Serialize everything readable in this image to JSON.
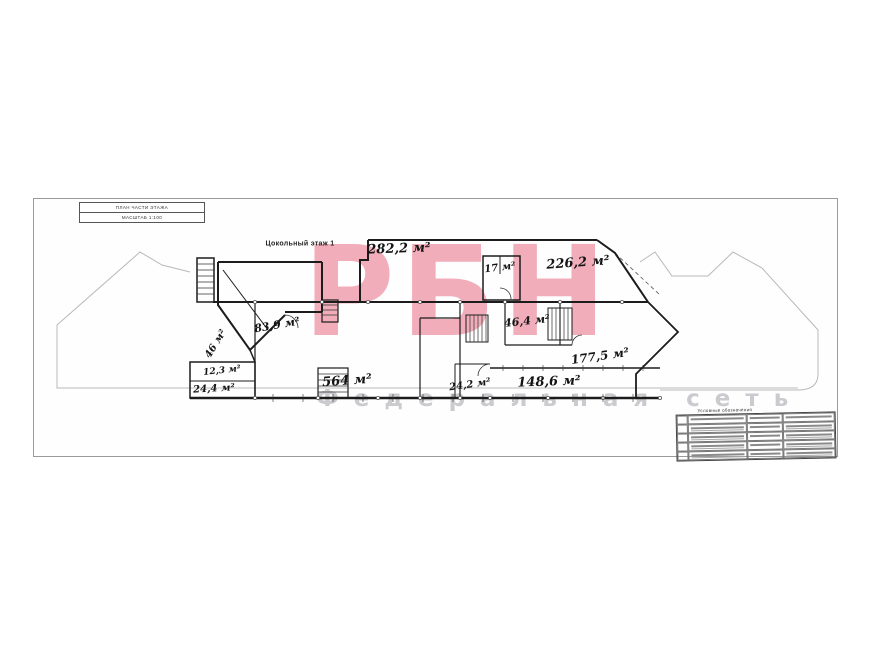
{
  "sheet": {
    "title_block": {
      "line1": "ПЛАН ЧАСТИ ЭТАЖА",
      "line2": "МАСШТАБ 1:100"
    },
    "floor_label": "Цокольный этаж 1"
  },
  "watermark": {
    "text": "РБН",
    "subtext": "Федеральная сеть",
    "color": "#f0a3b1",
    "subcolor": "#c6c6ca"
  },
  "plan": {
    "labels": [
      {
        "name": "area-282-2",
        "text": "282,2 м²"
      },
      {
        "name": "area-17",
        "text": "17 м²"
      },
      {
        "name": "area-226-2",
        "text": "226,2 м²"
      },
      {
        "name": "area-83-9",
        "text": "83,9 м²"
      },
      {
        "name": "area-46",
        "text": "46 м²"
      },
      {
        "name": "area-46-4",
        "text": "46,4 м²"
      },
      {
        "name": "area-177-5",
        "text": "177,5 м²"
      },
      {
        "name": "area-12-3",
        "text": "12,3 м²"
      },
      {
        "name": "area-24-4",
        "text": "24,4 м²"
      },
      {
        "name": "area-564",
        "text": "564 м²"
      },
      {
        "name": "area-24-2",
        "text": "24,2 м²"
      },
      {
        "name": "area-148-6",
        "text": "148,6 м²"
      }
    ]
  },
  "legend": {
    "title": "Условные обозначения"
  }
}
